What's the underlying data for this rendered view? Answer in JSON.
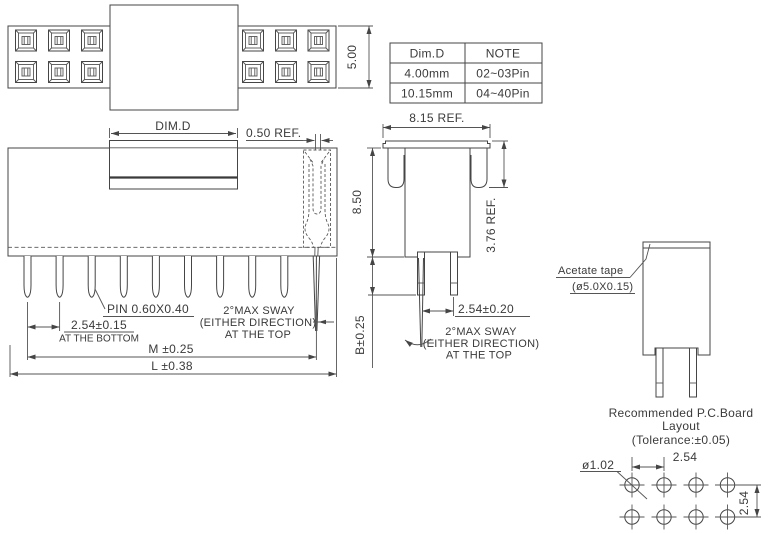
{
  "colors": {
    "line": "#454545",
    "text": "#3a3a3a",
    "background": "#ffffff"
  },
  "drawing": {
    "table": {
      "headers": [
        "Dim.D",
        "NOTE"
      ],
      "rows": [
        [
          "4.00mm",
          "02~03Pin"
        ],
        [
          "10.15mm",
          "04~40Pin"
        ]
      ]
    },
    "top_view": {
      "height_dim": "5.00"
    },
    "front_view": {
      "dim_d": "DIM.D",
      "slot_ref": "0.50  REF.",
      "pin_size": "PIN  0.60X0.40",
      "pitch": "2.54±0.15",
      "pitch_note": "AT THE BOTTOM",
      "sway1": "2°MAX  SWAY",
      "sway2": "(EITHER  DIRECTION)",
      "sway3": "AT  THE  TOP",
      "m_dim": "M  ±0.25",
      "l_dim": "L  ±0.38"
    },
    "side_view": {
      "width_ref": "8.15  REF.",
      "height": "8.50",
      "flange_ref": "3.76  REF.",
      "pin_len": "B±0.25",
      "pitch": "2.54±0.20",
      "sway1": "2°MAX  SWAY",
      "sway2": "(EITHER  DIRECTION)",
      "sway3": "AT  THE  TOP"
    },
    "tape_view": {
      "label": "Acetate  tape",
      "size": "(ø5.0X0.15)"
    },
    "pcb_layout": {
      "title1": "Recommended  P.C.Board",
      "title2": "Layout",
      "title3": "(Tolerance:±0.05)",
      "hole_dia": "ø1.02",
      "pitch_h": "2.54",
      "pitch_v": "2.54"
    }
  }
}
